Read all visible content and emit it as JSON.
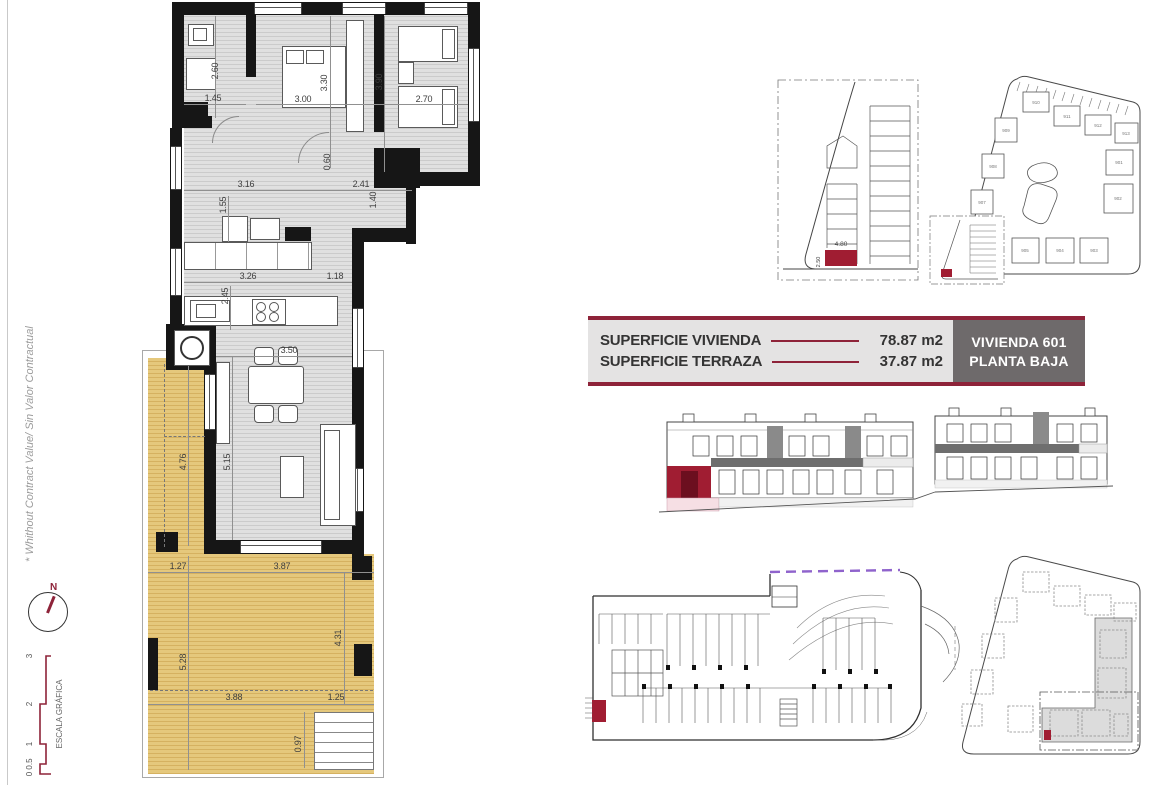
{
  "colors": {
    "accent": "#8E2339",
    "highlight": "#A01D32",
    "purple": "#8F63CC",
    "terrace": "#E5C87C",
    "floor_gray": "#E0E0E0",
    "table_bg": "#E4E3E3",
    "table_box": "#6E6A6B"
  },
  "side": {
    "disclaimer": "* Whithout Contract Value/ Sin Valor Contractual",
    "compass_label": "N",
    "scale_title": "ESCALA GRÁFICA",
    "scale_ticks": [
      "0",
      "0.5",
      "1",
      "2",
      "3"
    ]
  },
  "info_table": {
    "rows": [
      {
        "label": "SUPERFICIE VIVIENDA",
        "value": "78.87 m2"
      },
      {
        "label": "SUPERFICIE TERRAZA",
        "value": "37.87 m2"
      }
    ],
    "unit_line1": "VIVIENDA 601",
    "unit_line2": "PLANTA BAJA"
  },
  "floor_plan": {
    "dims": [
      {
        "t": "2.60"
      },
      {
        "t": "1.45"
      },
      {
        "t": "3.00"
      },
      {
        "t": "3.30"
      },
      {
        "t": "3.90"
      },
      {
        "t": "2.70"
      },
      {
        "t": "0.60"
      },
      {
        "t": "3.16"
      },
      {
        "t": "2.41"
      },
      {
        "t": "1.40"
      },
      {
        "t": "1.55"
      },
      {
        "t": "3.26"
      },
      {
        "t": "1.18"
      },
      {
        "t": "2.45"
      },
      {
        "t": "3.50"
      },
      {
        "t": "5.15"
      },
      {
        "t": "4.76"
      },
      {
        "t": "1.27"
      },
      {
        "t": "3.87"
      },
      {
        "t": "5.28"
      },
      {
        "t": "4.31"
      },
      {
        "t": "3.88"
      },
      {
        "t": "1.25"
      },
      {
        "t": "0.97"
      }
    ]
  },
  "parking_plan": {
    "dim_w": "4.80",
    "dim_h": "2.50"
  },
  "site_plan": {
    "labels": [
      "910",
      "911",
      "912",
      "913",
      "909",
      "908",
      "907",
      "906",
      "905",
      "904",
      "903",
      "902",
      "901"
    ]
  }
}
